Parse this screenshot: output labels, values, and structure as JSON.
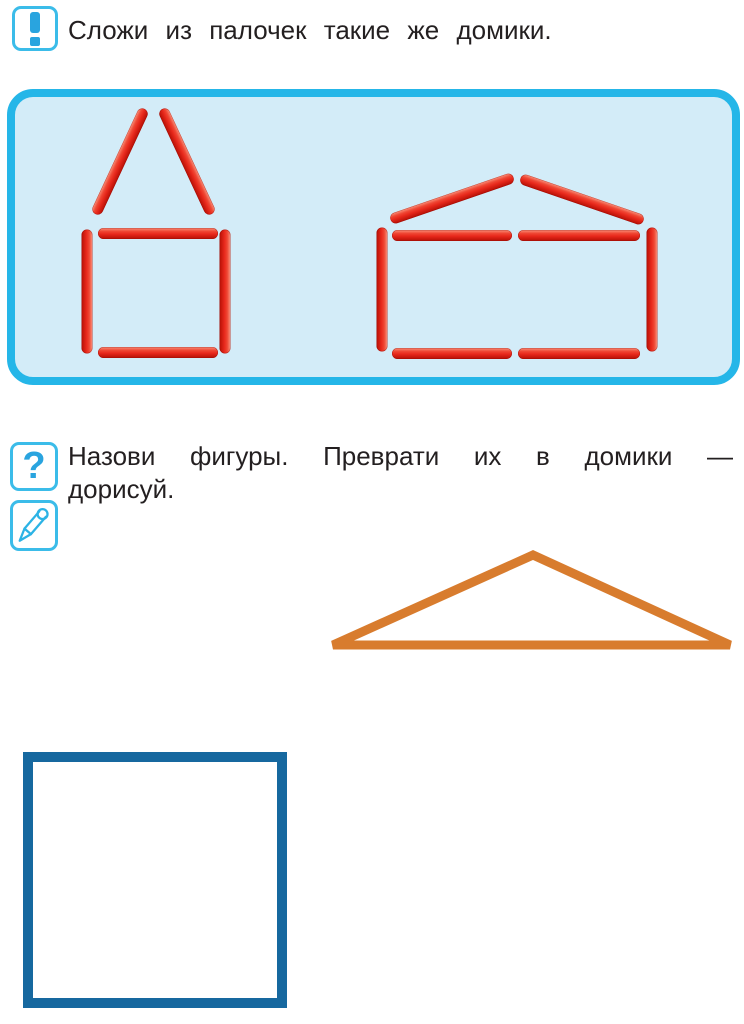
{
  "task1": {
    "icon": "exclamation-icon",
    "text": "Сложи из палочек такие же домики."
  },
  "task2": {
    "icons": [
      "question-icon",
      "pencil-icon"
    ],
    "question_glyph": "?",
    "line1": "Назови фигуры. Преврати их в домики —",
    "line2": "дорисуй."
  },
  "colors": {
    "panel_border": "#25b6e8",
    "panel_bg": "#d3ecf8",
    "icon_border": "#3bbce9",
    "icon_glyph": "#29a4df",
    "stick_red": "#e8291c",
    "stick_highlight": "#f9937e",
    "stick_dark": "#b50f05",
    "triangle": "#d87c2e",
    "square": "#16689f",
    "text": "#231f20"
  },
  "matchsticks": {
    "thickness": 11,
    "houses": [
      "small-house-left",
      "wide-house-right"
    ],
    "sticks": [
      {
        "part": "left-roof-left",
        "x": 120,
        "y": 161,
        "len": 116,
        "angle": -65
      },
      {
        "part": "left-roof-right",
        "x": 187,
        "y": 161,
        "len": 116,
        "angle": 65
      },
      {
        "part": "left-wall-left",
        "x": 87,
        "y": 291,
        "len": 124,
        "angle": 90
      },
      {
        "part": "left-top",
        "x": 158,
        "y": 233,
        "len": 120,
        "angle": 0
      },
      {
        "part": "left-wall-right",
        "x": 225,
        "y": 291,
        "len": 124,
        "angle": 90
      },
      {
        "part": "left-bottom",
        "x": 158,
        "y": 352,
        "len": 120,
        "angle": 0
      },
      {
        "part": "right-roof-left",
        "x": 452,
        "y": 198,
        "len": 130,
        "angle": -19
      },
      {
        "part": "right-roof-right",
        "x": 582,
        "y": 199,
        "len": 130,
        "angle": 19
      },
      {
        "part": "right-wall-left",
        "x": 382,
        "y": 289,
        "len": 124,
        "angle": 90
      },
      {
        "part": "right-top-1",
        "x": 452,
        "y": 235,
        "len": 120,
        "angle": 0
      },
      {
        "part": "right-top-2",
        "x": 579,
        "y": 235,
        "len": 122,
        "angle": 0
      },
      {
        "part": "right-wall-right",
        "x": 652,
        "y": 289,
        "len": 124,
        "angle": 90
      },
      {
        "part": "right-bottom-1",
        "x": 452,
        "y": 353,
        "len": 120,
        "angle": 0
      },
      {
        "part": "right-bottom-2",
        "x": 579,
        "y": 353,
        "len": 122,
        "angle": 0
      }
    ]
  },
  "shapes": {
    "triangle": {
      "name": "roof-triangle-outline",
      "svg_size": [
        415,
        115
      ],
      "points": [
        [
          208,
          10
        ],
        [
          8,
          100
        ],
        [
          405,
          100
        ]
      ],
      "stroke_width": 9
    },
    "square": {
      "name": "house-square-outline"
    }
  }
}
